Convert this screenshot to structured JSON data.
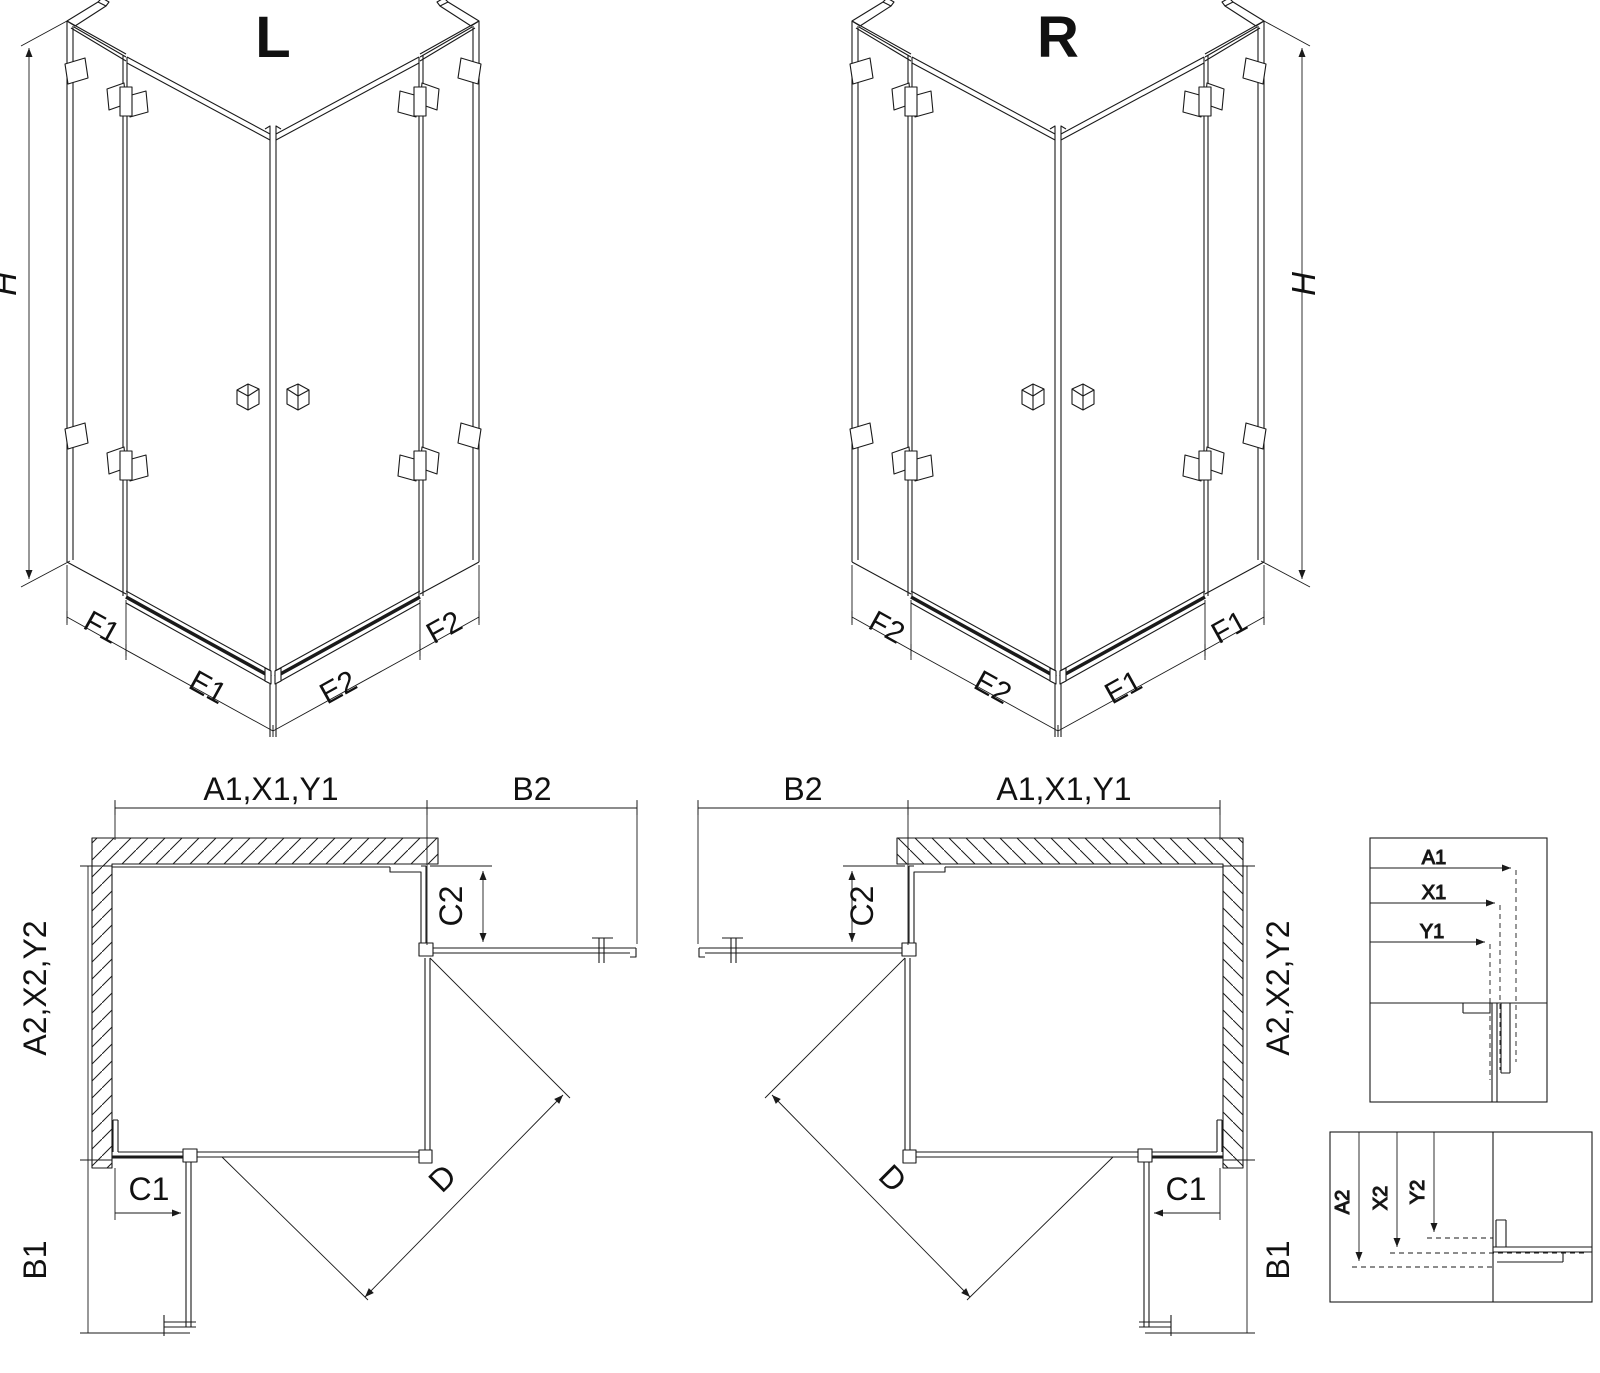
{
  "drawing": {
    "background": "#ffffff",
    "line_color": "#1a1a1a",
    "iso_left": {
      "title": "L",
      "height": "H",
      "seg_far_left": "F1",
      "seg_left": "E1",
      "seg_right": "E2",
      "seg_far_right": "F2"
    },
    "iso_right": {
      "title": "R",
      "height": "H",
      "seg_far_left": "F2",
      "seg_left": "E2",
      "seg_right": "E1",
      "seg_far_right": "F1"
    },
    "plan_left": {
      "width_top": "A1,X1,Y1",
      "door_top": "B2",
      "fixed_right": "C2",
      "depth_side": "A2,X2,Y2",
      "fixed_bottom": "C1",
      "door_side": "B1",
      "diagonal": "D"
    },
    "plan_right": {
      "width_top": "A1,X1,Y1",
      "door_top": "B2",
      "fixed_right": "C2",
      "depth_side": "A2,X2,Y2",
      "fixed_bottom": "C1",
      "door_side": "B1",
      "diagonal": "D"
    },
    "detail_width": {
      "row1": "A1",
      "row2": "X1",
      "row3": "Y1"
    },
    "detail_depth": {
      "row1": "A2",
      "row2": "X2",
      "row3": "Y2"
    }
  }
}
